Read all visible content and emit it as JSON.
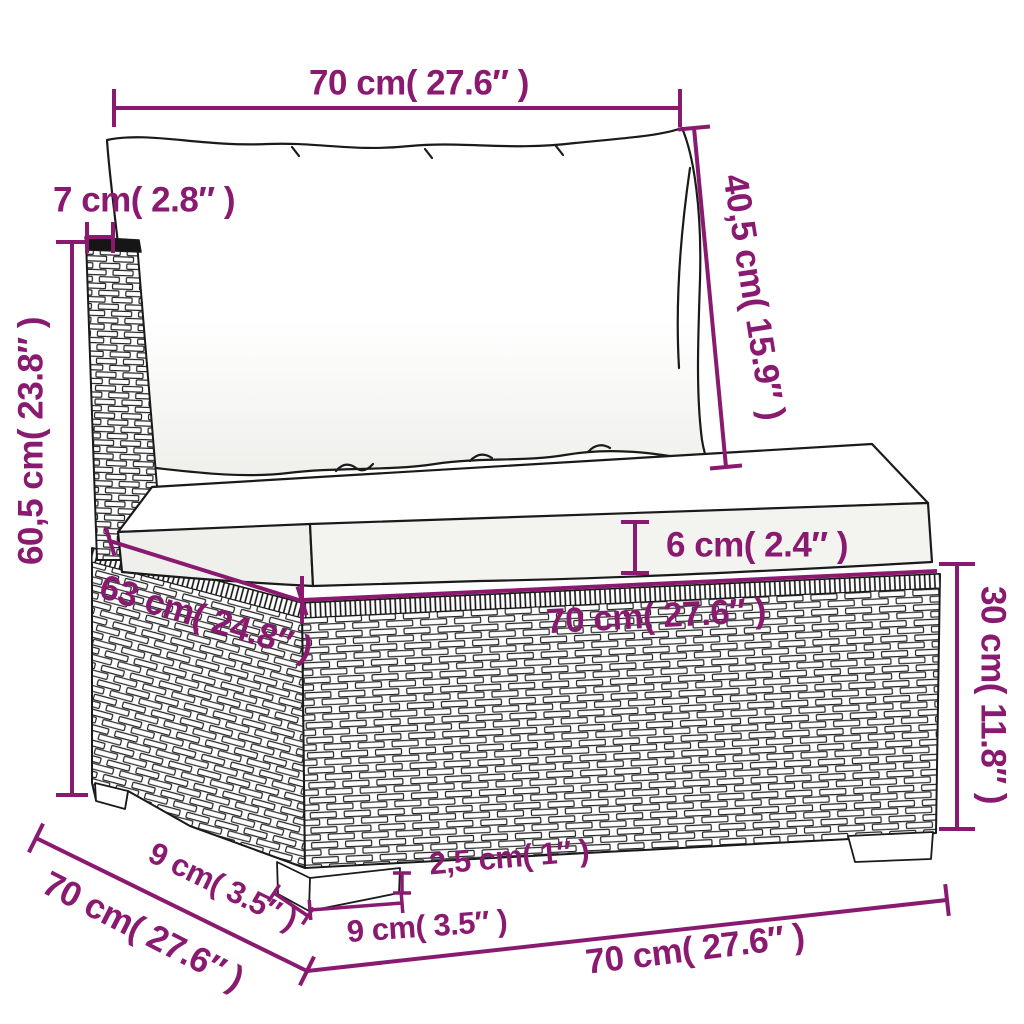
{
  "accent_color": "#8a1a70",
  "artwork": {
    "subject": "rattan-sofa-middle-section-with-cushions",
    "style": "black-outline-line-art"
  },
  "dimensions": {
    "back_width": "70 cm( 27.6″ )",
    "back_depth": "7 cm( 2.8″ )",
    "back_cushion_height": "40,5 cm( 15.9″ )",
    "total_height": "60,5 cm( 23.8″ )",
    "seat_depth": "63 cm( 24.8″ )",
    "seat_cushion_thickness": "6 cm( 2.4″ )",
    "seat_width": "70 cm( 27.6″ )",
    "base_height": "30 cm( 11.8″ )",
    "leg_height": "2,5 cm( 1″ )",
    "leg_depth": "9 cm( 3.5″ )",
    "leg_width": "9 cm( 3.5″ )",
    "base_depth": "70 cm( 27.6″ )",
    "base_width": "70 cm( 27.6″ )"
  }
}
